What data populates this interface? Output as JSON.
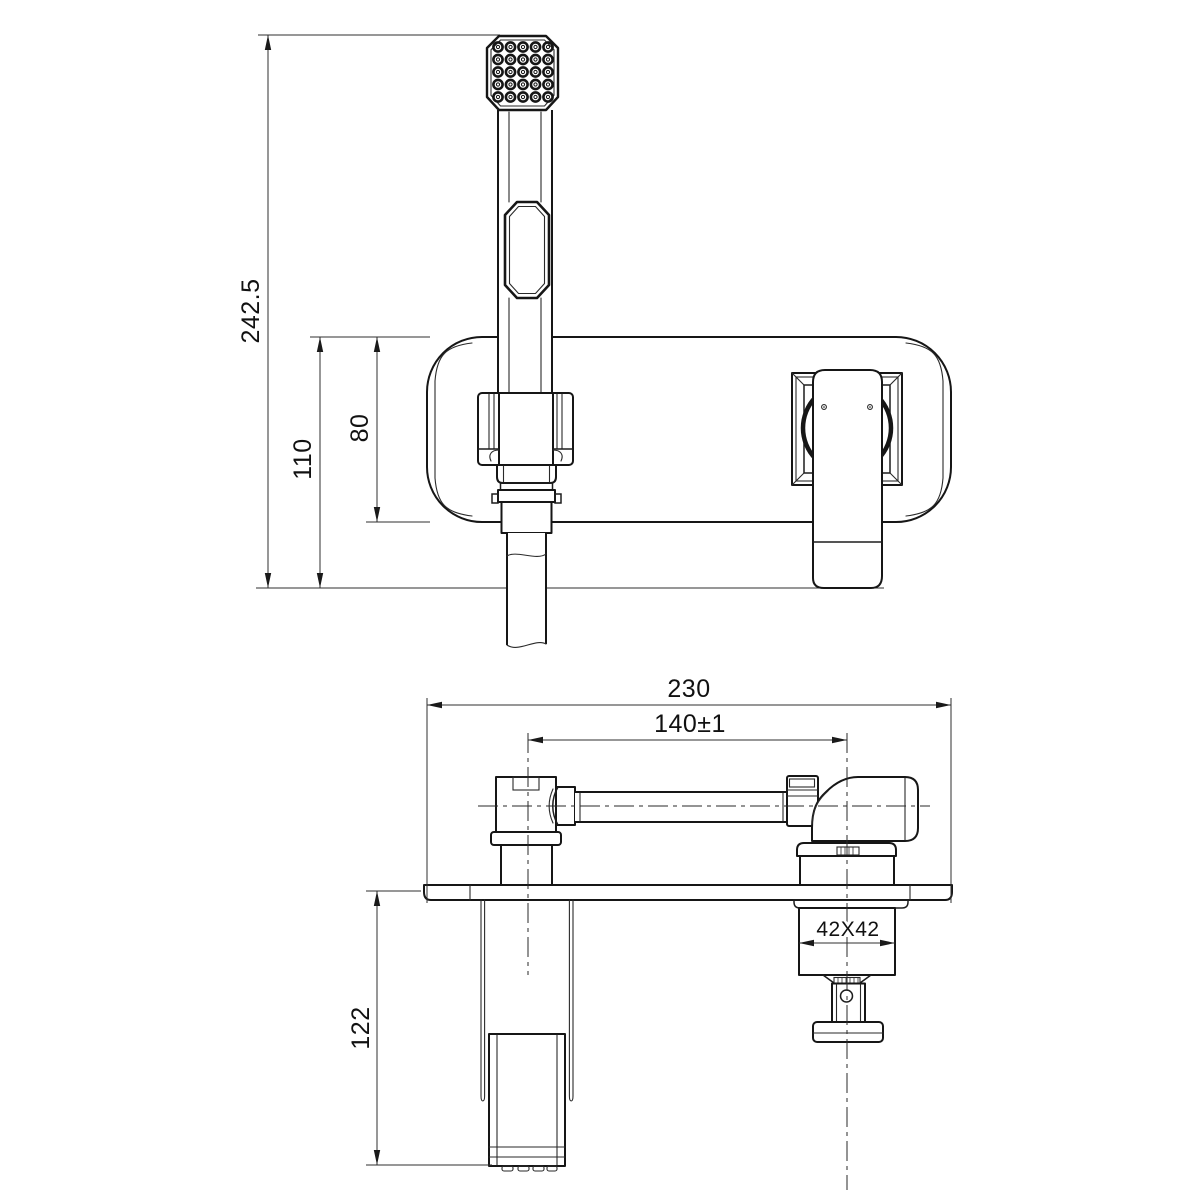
{
  "drawing": {
    "kind": "faucet-installation-technical-drawing",
    "views": [
      "front-elevation",
      "side-section"
    ]
  },
  "dimensions": {
    "front": {
      "total_height": "242.5",
      "holder_offset": "110",
      "plate_height": "80"
    },
    "side": {
      "plate_width": "230",
      "center_spacing": "140±1",
      "valve_section": "42X42",
      "wall_depth": "122"
    }
  },
  "colors": {
    "line": "#161616",
    "dim_line": "#2f2f2f",
    "background": "#ffffff"
  }
}
